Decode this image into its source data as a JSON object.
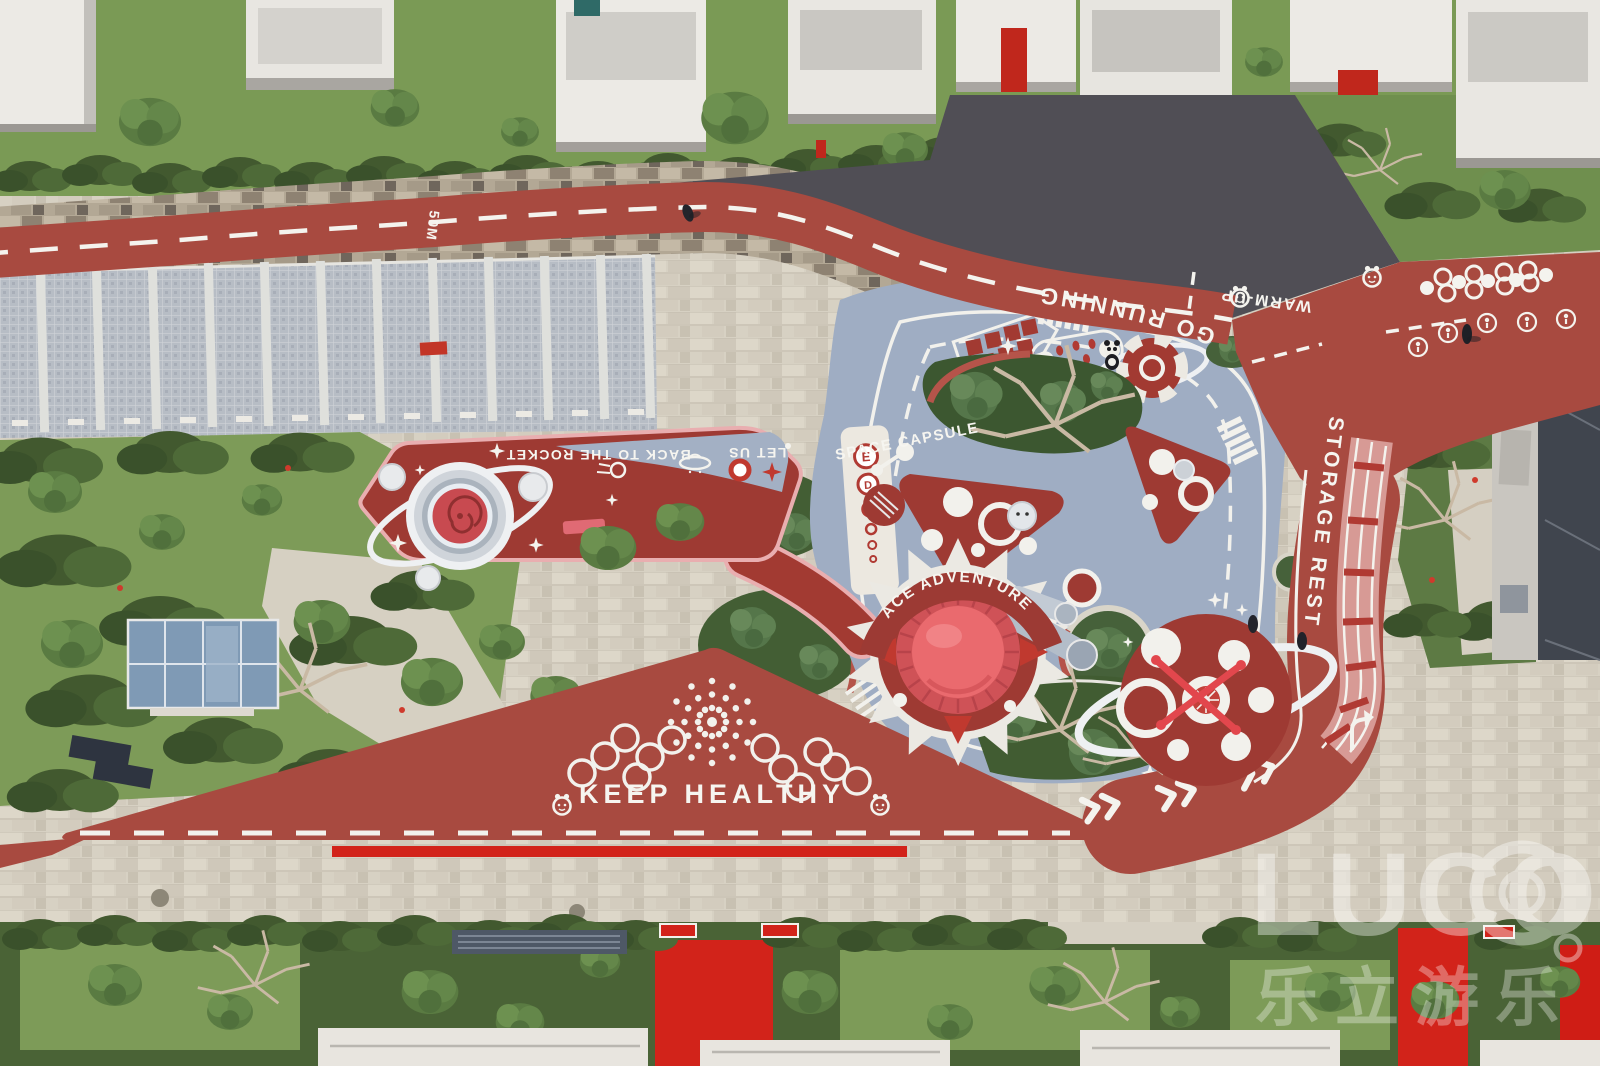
{
  "labels": {
    "distance_marker": "50M",
    "go_running": "GO RUNNING",
    "warm_up": "WARM-UP",
    "storage_rest": "STORAGE REST",
    "space_capsule": "SPACE CAPSULE",
    "back_to_rocket": "BACK TO THE ROCKET",
    "let_us": "LET US",
    "ace_adventure": "ACE ADVENTURE",
    "keep_healthy": "KEEP HEALTHY"
  },
  "eye_chart": {
    "letters": [
      "E",
      "D"
    ]
  },
  "watermark": {
    "brand": "LUCO",
    "cjk": "乐立游乐"
  },
  "colors": {
    "track_red": "#a84a40",
    "pad_red": "#9e3a33",
    "bright_red": "#d2231a",
    "playground_blue": "#9fadc3",
    "paving_light": "#d7d1c3",
    "paving_dark": "#504e55",
    "grass": "#7a9a55",
    "hedge": "#3f5730",
    "white_marking": "#f2f1ec"
  }
}
